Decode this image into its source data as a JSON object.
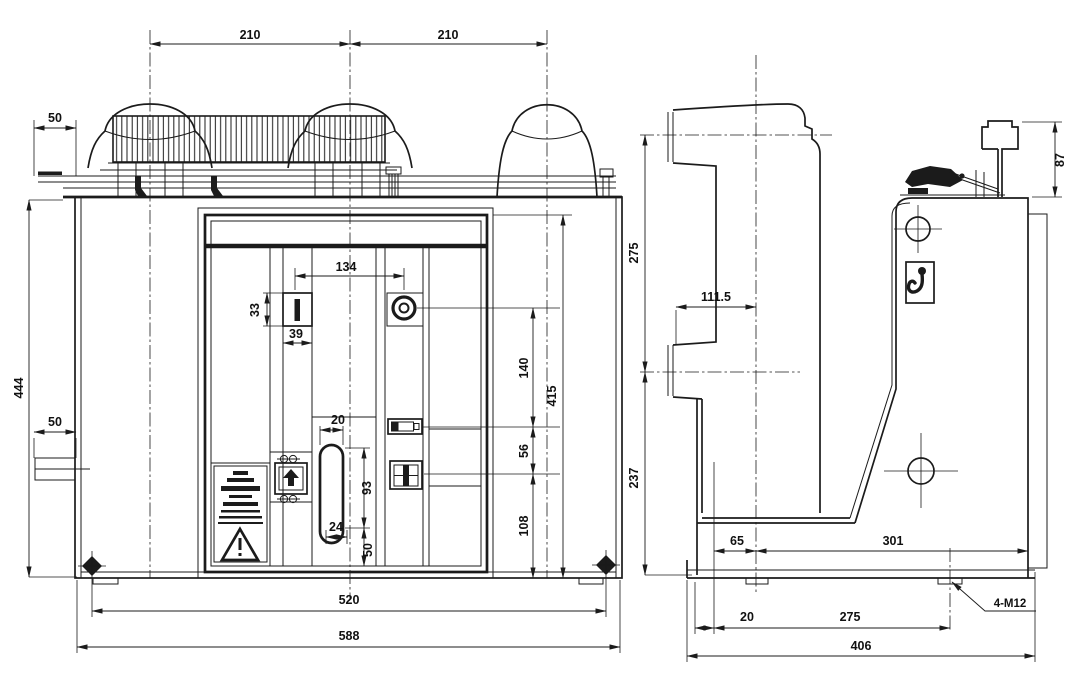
{
  "colors": {
    "background": "#ffffff",
    "line": "#1b1b1b"
  },
  "front_view": {
    "dims": {
      "pole_pitch_left": "210",
      "pole_pitch_right": "210",
      "rail_overhang": "50",
      "overall_height": "444",
      "bracket_offset": "50",
      "button_pitch": "134",
      "button_height": "33",
      "button_width": "39",
      "keyhole_width": "20",
      "keyhole_height": "93",
      "keyhole_base": "24",
      "keyhole_bottom_offset": "50",
      "circle_to_counter": "140",
      "counter_to_indicator": "56",
      "indicator_to_bottom": "108",
      "panel_height": "415",
      "foot_pitch": "520",
      "overall_width": "588"
    }
  },
  "side_view": {
    "dims": {
      "upper_to_lower_arm": "275",
      "arm_reach": "111.5",
      "lower_arm_to_base": "237",
      "hanger_height": "87",
      "pole_offset": "65",
      "body_depth": "301",
      "foot_offset": "20",
      "foot_pitch_depth": "275",
      "overall_depth": "406"
    },
    "labels": {
      "mounting_bolts": "4-M12"
    }
  }
}
